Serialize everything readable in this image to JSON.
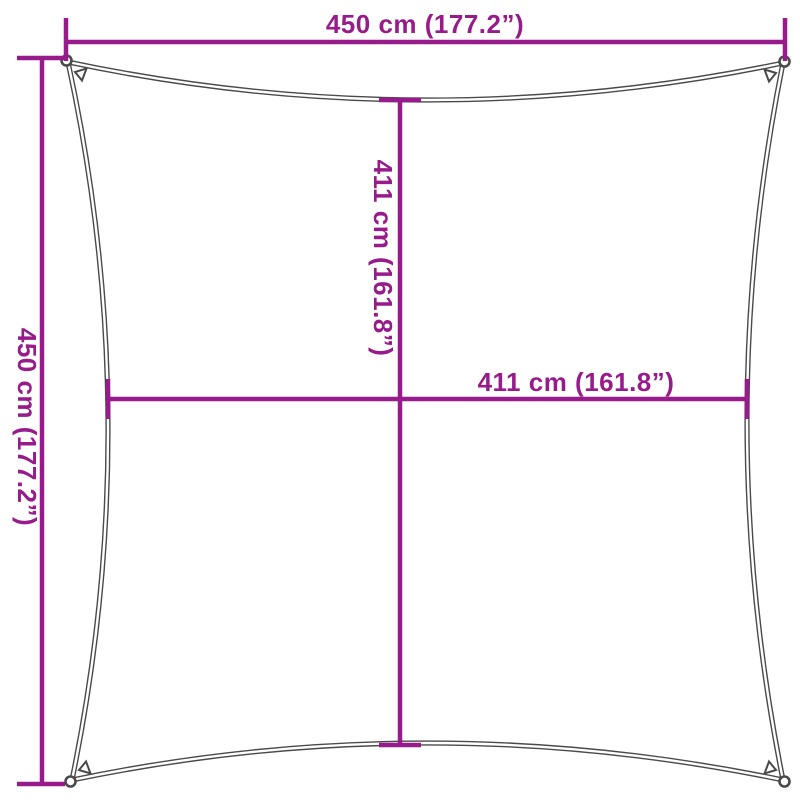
{
  "page": {
    "background": "#ffffff"
  },
  "colors": {
    "accent": "#971b8b",
    "outline": "#4a4a4a"
  },
  "labels": {
    "top": "450 cm (177.2”)",
    "left": "450 cm (177.2”)",
    "inner_vertical": "411 cm (161.8”)",
    "inner_horizontal": "411 cm (161.8”)"
  },
  "dimensions": {
    "outer_width": {
      "cm": 450,
      "inches": 177.2
    },
    "outer_height": {
      "cm": 450,
      "inches": 177.2
    },
    "inner_width": {
      "cm": 411,
      "inches": 161.8
    },
    "inner_height": {
      "cm": 411,
      "inches": 161.8
    }
  }
}
